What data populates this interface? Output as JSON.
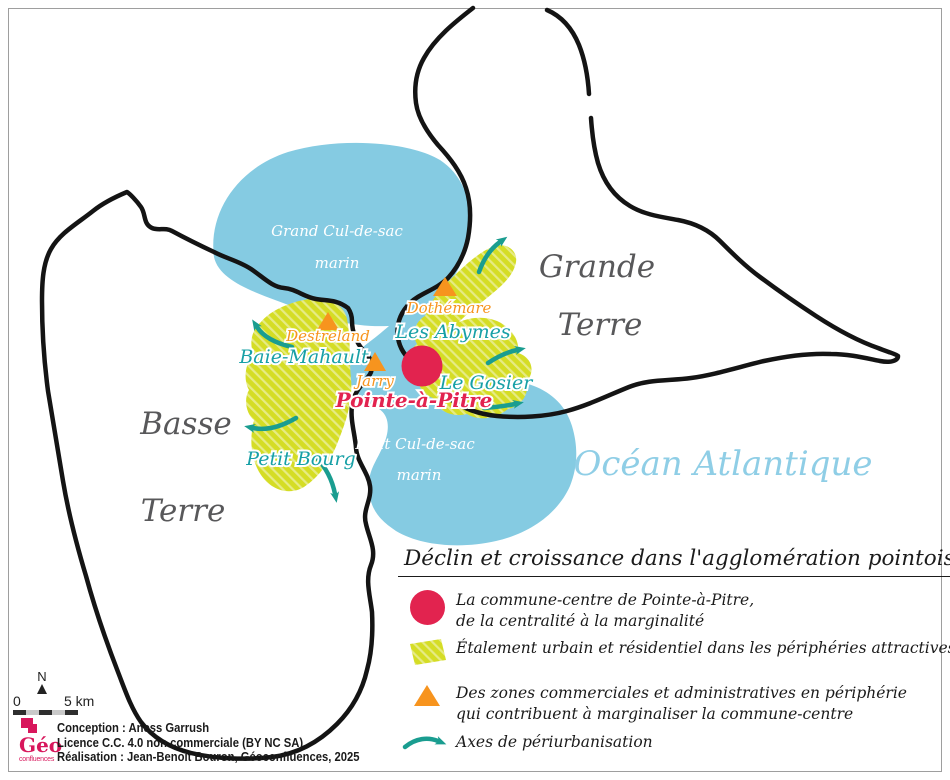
{
  "map": {
    "island_labels": {
      "grande_terre": [
        "Grande",
        "Terre"
      ],
      "basse_terre": [
        "Basse",
        "Terre"
      ],
      "ocean": "Océan Atlantique"
    },
    "water_labels": {
      "grand_cul_de_sac": [
        "Grand Cul-de-sac",
        "marin"
      ],
      "petit_cul_de_sac": [
        "Petit Cul-de-sac",
        "marin"
      ]
    },
    "towns": {
      "baie_mahault": "Baie-Mahault",
      "les_abymes": "Les Abymes",
      "le_gosier": "Le Gosier",
      "petit_bourg": "Petit Bourg",
      "pointe_a_pitre": "Pointe-à-Pitre"
    },
    "commercial_zones": {
      "destreland": "Destreland",
      "dothemare": "Dothémare",
      "jarry": "Jarry"
    }
  },
  "legend": {
    "title": "Déclin et croissance dans l'agglomération pointoise",
    "items": [
      {
        "symbol": "pink-circle",
        "lines": [
          "La commune-centre de Pointe-à-Pitre,",
          "de la centralité à la marginalité"
        ]
      },
      {
        "symbol": "yellow-hatch",
        "lines": [
          "Étalement urbain et résidentiel dans les périphéries attractives"
        ]
      },
      {
        "symbol": "orange-triangle",
        "lines": [
          "Des zones commerciales et administratives en périphérie",
          "qui contribuent à marginaliser la commune-centre"
        ]
      },
      {
        "symbol": "teal-arrow",
        "lines": [
          "Axes de périurbanisation"
        ]
      }
    ]
  },
  "scale_bar": {
    "north_label": "N",
    "start": "0",
    "end": "5 km"
  },
  "credits": [
    "Conception : Aness Garrush",
    "Licence C.C. 4.0 non commerciale (BY NC SA)",
    "Réalisation : Jean-Benoît Bouron, Géoconfluences, 2025"
  ],
  "logo": {
    "geo": "Géo",
    "confluences": "confluences"
  },
  "colors": {
    "water": "#85cbe2",
    "sprawl": "#d5dd25",
    "center": "#e2234f",
    "commercial": "#f7941e",
    "axes": "#1a9d90",
    "island_text": "#58585a",
    "ocean_text": "#8fcee6"
  }
}
